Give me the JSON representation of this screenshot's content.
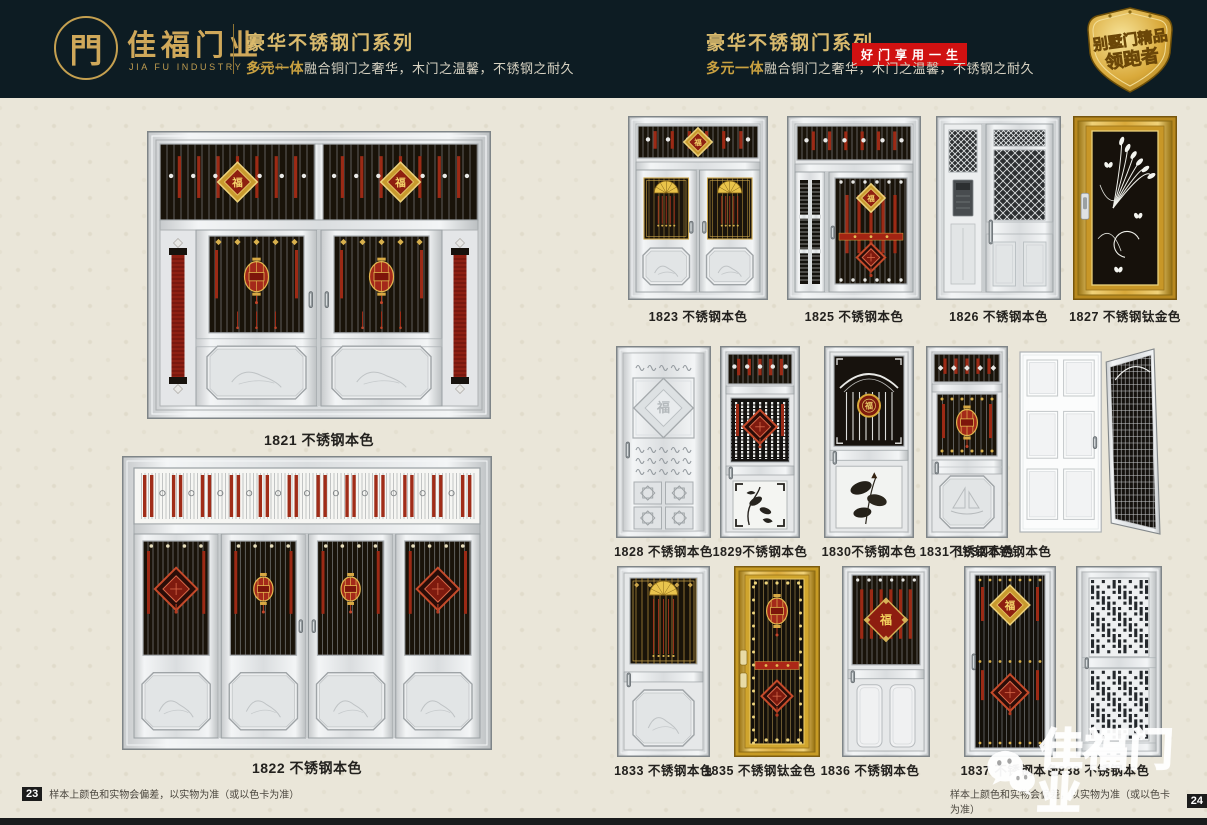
{
  "header": {
    "logo": {
      "glyph": "門",
      "brand": "佳福门业",
      "brand_en": "JIA FU INDUSTRY DOOR"
    },
    "left_block": {
      "title": "豪华不锈钢门系列",
      "subtitle_strong": "多元一体",
      "subtitle_rest": "融合铜门之奢华，木门之温馨，不锈钢之耐久"
    },
    "right_block": {
      "title": "豪华不锈钢门系列",
      "badge": "好门享用一生",
      "subtitle_strong": "多元一体",
      "subtitle_rest": "融合铜门之奢华，木门之温馨，不锈钢之耐久"
    },
    "emblem": {
      "line1": "别墅门精品",
      "line2": "领跑者"
    }
  },
  "pages": {
    "left": {
      "page_number": "23",
      "disclaimer": "样本上颜色和实物会偏差，以实物为准（或以色卡为准）"
    },
    "right": {
      "page_number": "24",
      "disclaimer": "样本上颜色和实物会偏差，以实物为准（或以色卡为准）"
    }
  },
  "watermark": {
    "brand": "佳福门业"
  },
  "colors": {
    "header_bg": "#0d1c23",
    "gold": "#cfa85a",
    "badge_red": "#d01111",
    "page_bg": "#eae6d9",
    "steel": "#d9dcde",
    "titanium_gold": "#d9a93a"
  },
  "doors": [
    {
      "model": "1821",
      "label": "1821 不锈钢本色",
      "style": "grand"
    },
    {
      "model": "1822",
      "label": "1822 不锈钢本色",
      "style": "fourleaf"
    },
    {
      "model": "1823",
      "label": "1823 不锈钢本色",
      "style": "dfan"
    },
    {
      "model": "1825",
      "label": "1825 不锈钢本色",
      "style": "momfu"
    },
    {
      "model": "1826",
      "label": "1826 不锈钢本色",
      "style": "momlat"
    },
    {
      "model": "1827",
      "label": "1827 不锈钢钛金色",
      "style": "goldpea"
    },
    {
      "model": "1828",
      "label": "1828 不锈钢本色",
      "style": "silvemb"
    },
    {
      "model": "1829",
      "label": "1829不锈钢本色",
      "style": "darkart"
    },
    {
      "model": "1830",
      "label": "1830不锈钢本色",
      "style": "arch"
    },
    {
      "model": "1831",
      "label": "1831不锈钢本色",
      "style": "translant"
    },
    {
      "model": "1832",
      "label": "1832不锈钢本色",
      "style": "openmesh"
    },
    {
      "model": "1833",
      "label": "1833 不锈钢本色",
      "style": "fanwin"
    },
    {
      "model": "1835",
      "label": "1835 不锈钢钛金色",
      "style": "goldgr"
    },
    {
      "model": "1836",
      "label": "1836 不锈钢本色",
      "style": "grifu"
    },
    {
      "model": "1837",
      "label": "1837 不锈钢本色",
      "style": "fullfu"
    },
    {
      "model": "1838",
      "label": "1838 不锈钢本色",
      "style": "perf"
    }
  ]
}
